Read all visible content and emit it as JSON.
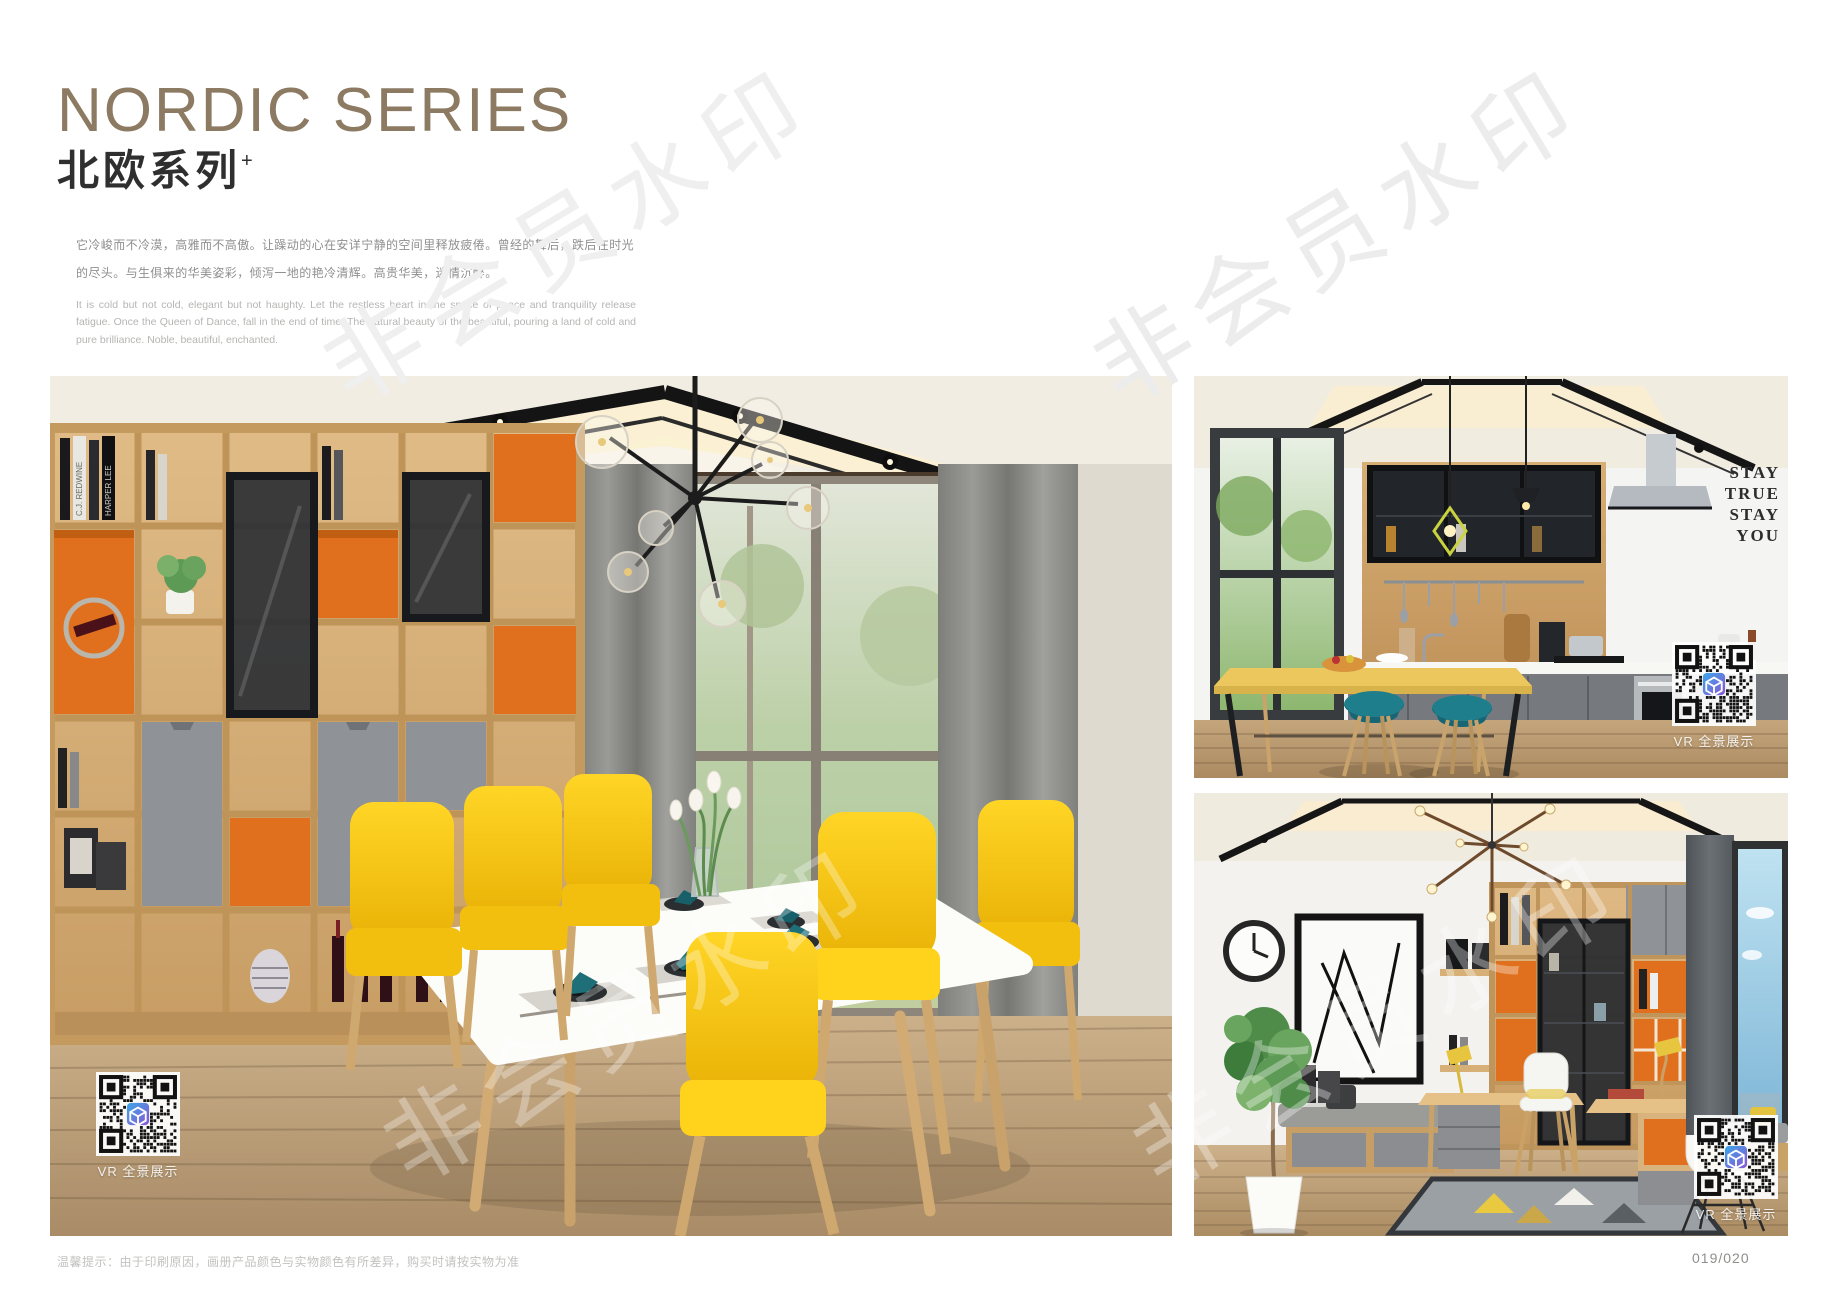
{
  "header": {
    "title_en": "NORDIC SERIES",
    "title_cn": "北欧系列",
    "title_sup": "+",
    "desc_cn": "它冷峻而不冷漠，高雅而不高傲。让躁动的心在安详宁静的空间里释放疲倦。曾经的舞后，跌后在时光的尽头。与生俱来的华美姿彩，倾泻一地的艳冷清辉。高贵华美，迷情沉醉。",
    "desc_en": "It is cold but not cold, elegant but not haughty. Let the restless heart in the space of peace and tranquility release fatigue. Once the Queen of Dance, fall in the end of time. The natural beauty of the beautiful, pouring a land of cold and pure brilliance. Noble, beautiful, enchanted."
  },
  "watermark": {
    "text": "非会员水印"
  },
  "photos": {
    "dining": {
      "vr_label": "VR 全景展示",
      "book_spine_1": "C.J. REDWINE",
      "book_spine_2": "HARPER LEE"
    },
    "kitchen": {
      "vr_label": "VR 全景展示",
      "wall_words": [
        "STAY",
        "TRUE",
        "STAY",
        "YOU"
      ]
    },
    "study": {
      "vr_label": "VR 全景展示"
    }
  },
  "footer": {
    "note": "温馨提示：由于印刷原因，画册产品颜色与实物颜色有所差异，购买时请按实物为准",
    "page_number": "019/020"
  },
  "colors": {
    "title_taupe": "#8C7B62",
    "accent_orange": "#E0701D",
    "chair_yellow": "#F5C91B",
    "stool_teal": "#1F7E8C",
    "cabinet_wood": "#D8B07C"
  }
}
